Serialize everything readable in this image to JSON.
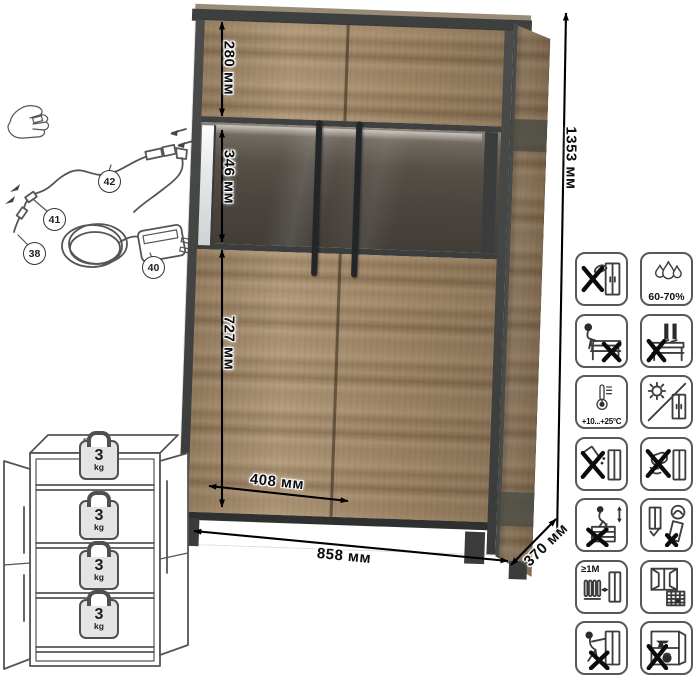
{
  "sheet": {
    "type": "furniture-specification-infographic"
  },
  "dimensions": {
    "total_height": "1353 мм",
    "total_width": "858 мм",
    "depth": "370 мм",
    "top_section": "280 мм",
    "glass_section": "346 мм",
    "lower_section": "727 мм",
    "door_width": "408 мм"
  },
  "led_kit": {
    "parts": [
      {
        "id": "42"
      },
      {
        "id": "41"
      },
      {
        "id": "38"
      },
      {
        "id": "40"
      }
    ]
  },
  "shelves": {
    "count": 4,
    "max_load_value": "3",
    "max_load_unit": "kg"
  },
  "care": {
    "humidity": "60-70%",
    "temperature": "+10...+25°C",
    "heater_distance": "≥1М",
    "icon_names": [
      "no-axe-impact",
      "humidity-range",
      "no-sitting",
      "no-standing",
      "temperature-range",
      "avoid-direct-sunlight",
      "no-liquids",
      "no-abrasive-cleaning",
      "no-climbing",
      "anchor-to-wall",
      "keep-distance-from-heater",
      "ventilate-room",
      "no-pushing-loaded",
      "no-heavy-items-inside"
    ]
  }
}
